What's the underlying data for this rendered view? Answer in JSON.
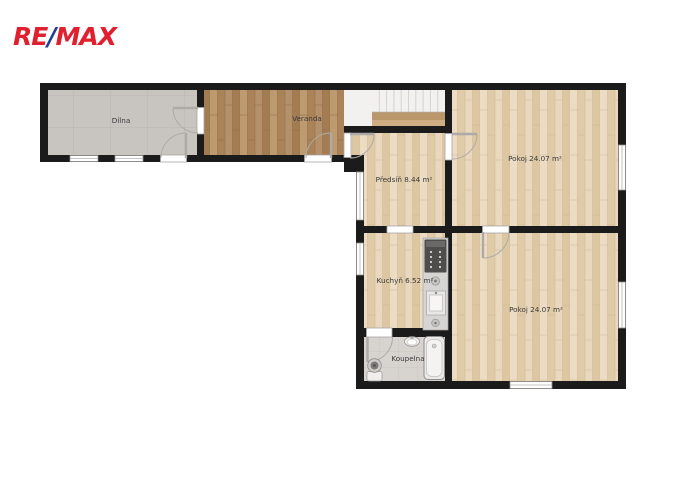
{
  "brand": {
    "re": "RE",
    "slash": "/",
    "max": "MAX",
    "red": "#e1202f",
    "blue": "#1e3f94"
  },
  "plan": {
    "type": "floor-plan",
    "rooms": {
      "dilna": {
        "label": "Dílna"
      },
      "veranda": {
        "label": "Veranda"
      },
      "predsin": {
        "label": "Předsíň 8.44 m²"
      },
      "pokoj_horni": {
        "label": "Pokoj 24.07 m²"
      },
      "kuchyn": {
        "label": "Kuchyň 6.52 m²"
      },
      "koupelna": {
        "label": "Koupelna"
      },
      "pokoj_dolni": {
        "label": "Pokoj 24.07 m²"
      }
    },
    "colors": {
      "wall": "#1b1b1b",
      "tile_gray": "#c8c5c1",
      "tile_bath": "#d7d4d0",
      "wood_light": "#e7d5b8",
      "wood_dark": "#b48d63",
      "stairs": "#f2f1ef"
    }
  }
}
